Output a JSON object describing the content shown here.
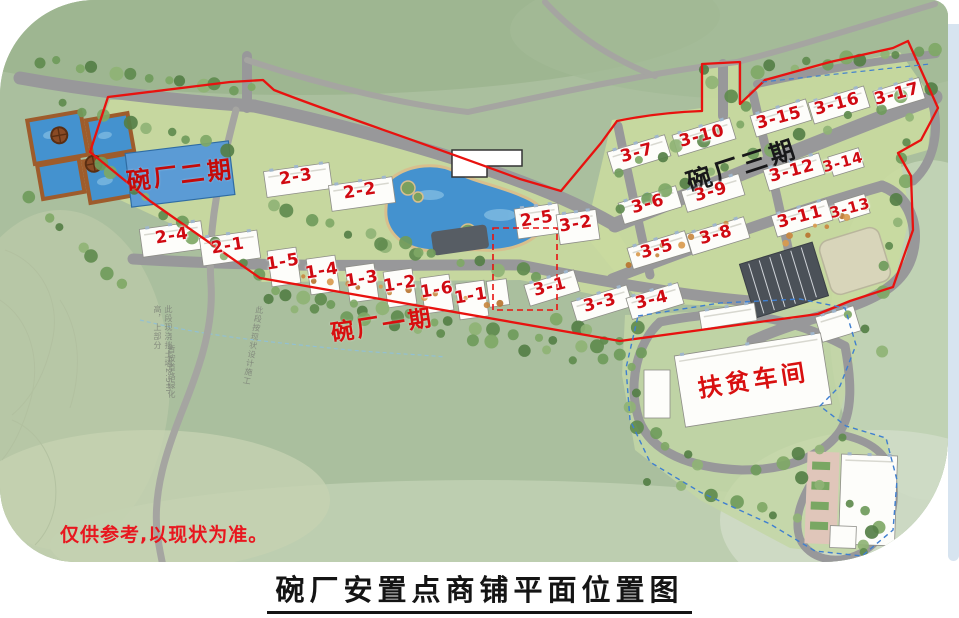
{
  "page": {
    "title": "碗厂安置点商铺平面位置图",
    "disclaimer": "仅供参考,以现状为准。"
  },
  "map": {
    "phase_labels": [
      {
        "text": "碗厂二期"
      },
      {
        "text": "碗厂三期"
      },
      {
        "text": "碗厂一期"
      },
      {
        "text": "扶贫车间"
      }
    ],
    "building_labels": [
      {
        "text": "2-1"
      },
      {
        "text": "2-2"
      },
      {
        "text": "2-3"
      },
      {
        "text": "2-4"
      },
      {
        "text": "2-5"
      },
      {
        "text": "1-1"
      },
      {
        "text": "1-2"
      },
      {
        "text": "1-3"
      },
      {
        "text": "1-4"
      },
      {
        "text": "1-5"
      },
      {
        "text": "1-6"
      },
      {
        "text": "3-1"
      },
      {
        "text": "3-2"
      },
      {
        "text": "3-3"
      },
      {
        "text": "3-4"
      },
      {
        "text": "3-5"
      },
      {
        "text": "3-6"
      },
      {
        "text": "3-7"
      },
      {
        "text": "3-8"
      },
      {
        "text": "3-9"
      },
      {
        "text": "3-10"
      },
      {
        "text": "3-11"
      },
      {
        "text": "3-12"
      },
      {
        "text": "3-13"
      },
      {
        "text": "3-14"
      },
      {
        "text": "3-15"
      },
      {
        "text": "3-16"
      },
      {
        "text": "3-17"
      }
    ],
    "annotations": [
      {
        "text": "此段现浇挡土墙2.5m高，上部分"
      },
      {
        "text": "暂按道路绿化"
      },
      {
        "text": "此段按现状设计施工"
      }
    ],
    "colors": {
      "boundary_red": "#e8120f",
      "boundary_dashed_blue": "#3f7fd0",
      "water_blue": "#4492cf",
      "label_red": "#d00a12",
      "phase2_panel_blue": "#5b9bd5",
      "road_gray": "#98989a"
    }
  }
}
